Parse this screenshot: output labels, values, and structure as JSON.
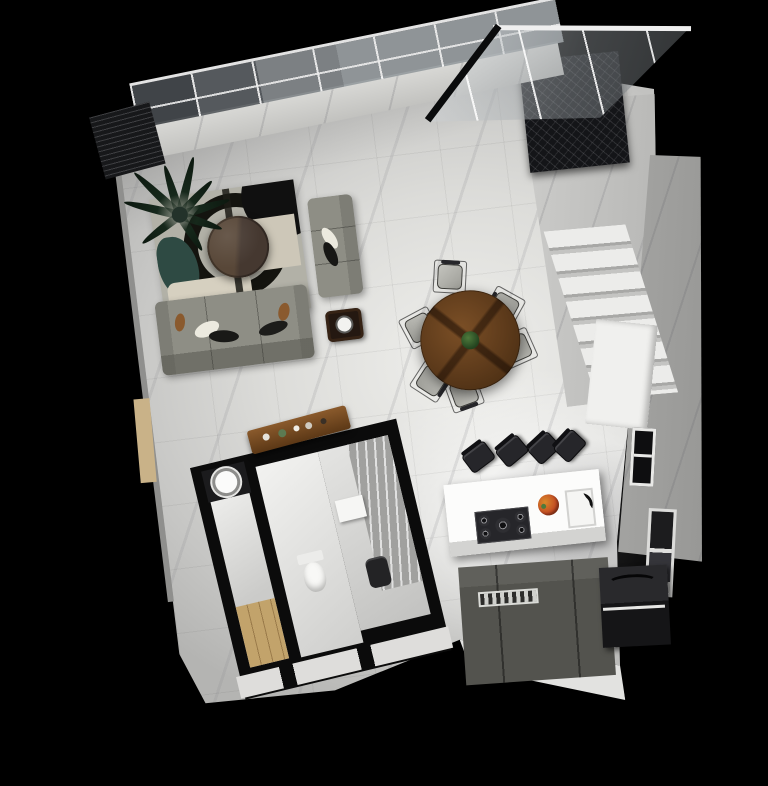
{
  "scene": {
    "kind": "3D architectural floor plan render",
    "view": "top-down cutaway of a studio apartment",
    "background": "#000000"
  },
  "palette": {
    "background": "#000000",
    "marble_floor": "#d6d6d3",
    "marble_wall": "#c9c9c7",
    "dark_wood": "#17181a",
    "sofa_fabric": "#8e8e85",
    "rug_base": "#b2b1a7",
    "rug_teal": "#2e4a43",
    "table_wood": "#5e3b1b",
    "counter_dark": "#53534e",
    "appliance_black": "#151517",
    "island_white": "#fcfcfb",
    "accent_beige": "#c2a36b"
  },
  "areas": {
    "skylight": {
      "label": "glass canopy skylight",
      "panel_count": 7
    },
    "roof_glass": {
      "label": "slanted glass roof panel over stairwell",
      "mullion_count": 3
    },
    "stairwell": {
      "label": "marble staircase with dark-wood upper landing",
      "visible_steps": 7
    },
    "living": {
      "label": "living area",
      "furniture": [
        "three-seat gray sofa",
        "gray armchair",
        "round dark-wood coffee table",
        "geometric patterned area rug",
        "palm floor plant",
        "dark side table with white bowl"
      ]
    },
    "dining": {
      "label": "dining area",
      "furniture": [
        "round wood dining table",
        "upholstered dining chairs",
        "green plant centerpiece"
      ],
      "chair_count": 6
    },
    "kitchen": {
      "label": "kitchen",
      "furniture": [
        "white island with gas cooktop, fruit bowl and sink",
        "dark bar stools",
        "dark base cabinets",
        "black appliance block",
        "framed window",
        "glass door"
      ],
      "bar_stool_count": 4,
      "cooktop_burner_count": 5
    },
    "bathroom": {
      "label": "bathroom suite",
      "furniture": [
        "round basin",
        "toilet",
        "glass shower enclosure",
        "dark shower stool",
        "wood console with decor objects"
      ],
      "room_count": 3,
      "console_item_count": 5
    },
    "entry": {
      "label": "wood entry strip",
      "material": "wood"
    }
  }
}
